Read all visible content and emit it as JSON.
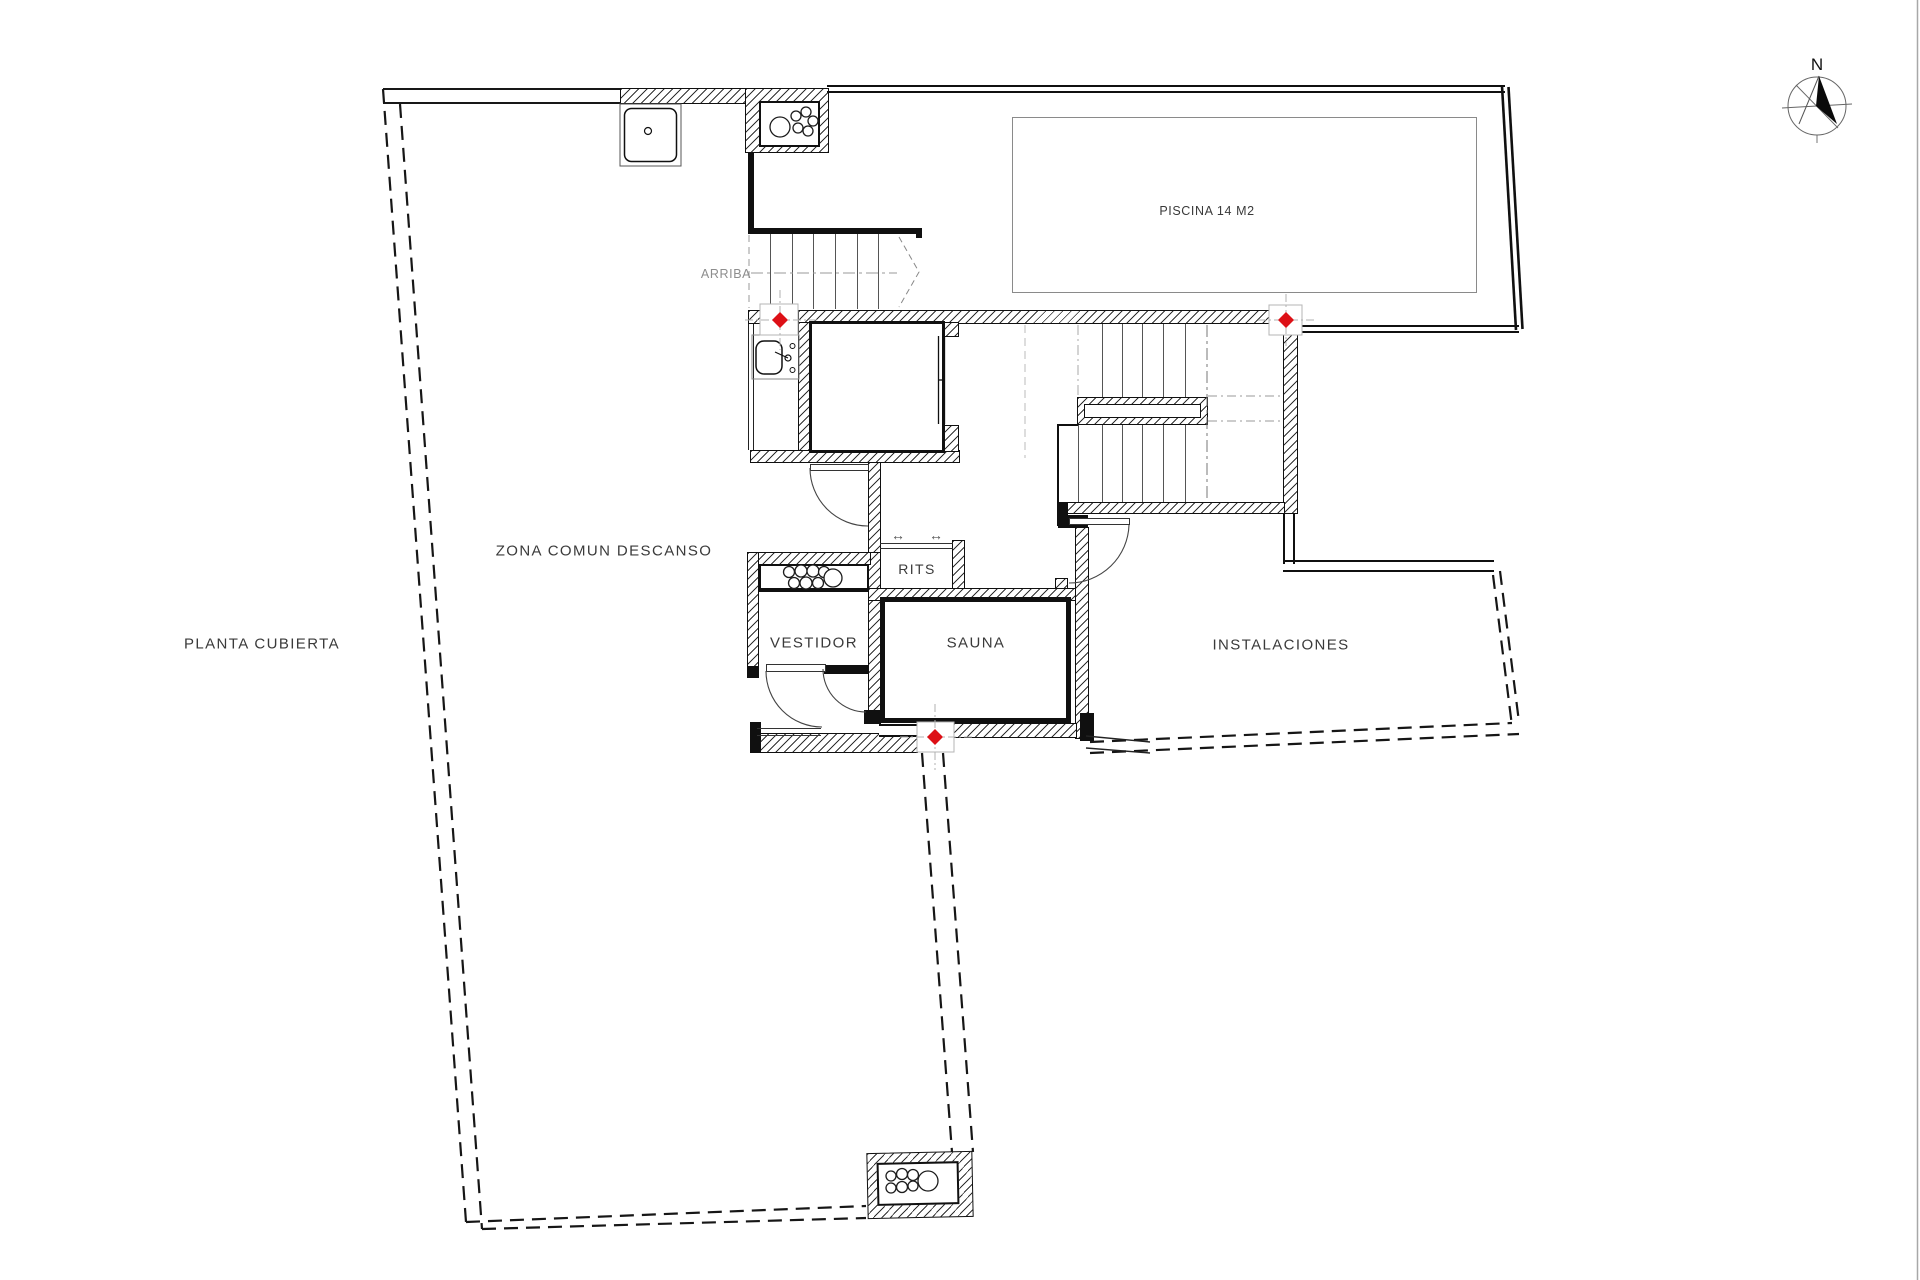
{
  "meta": {
    "drawing_type": "architectural roof floor plan",
    "sheet_background": "#ffffff"
  },
  "labels": {
    "plan_title": "PLANTA CUBIERTA",
    "common_zone": "ZONA COMUN DESCANSO",
    "pool": "PISCINA 14 M2",
    "stairs_up": "ARRIBA",
    "rits": "RITS",
    "dressing_room": "VESTIDOR",
    "sauna": "SAUNA",
    "installations": "INSTALACIONES",
    "north": "N",
    "vent_arrow": "↔"
  },
  "markers": {
    "count": 3,
    "shape": "red diamond level marker",
    "color": "#dd1016"
  },
  "colors": {
    "line_black": "#101010",
    "text_gray": "#3a3a3a",
    "muted_gray": "#8d8d8d",
    "edge_gray": "#a8a8a8"
  }
}
